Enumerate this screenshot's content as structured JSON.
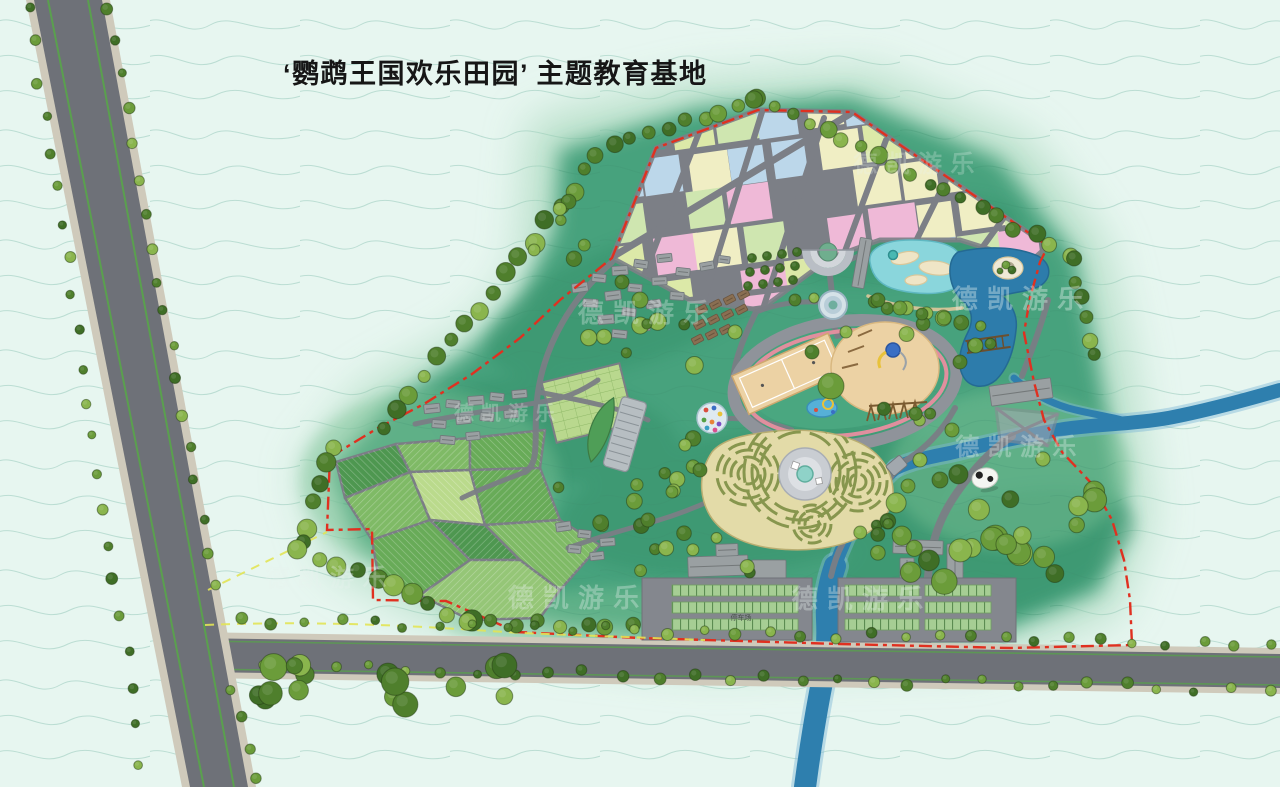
{
  "title": {
    "text": "‘鹦鹉王国欢乐田园’ 主题教育基地"
  },
  "labels": {
    "parking": "停车场"
  },
  "watermark": {
    "text": "德凯游乐",
    "color": "#e8f1ee",
    "instances": [
      [
        648,
        322,
        26,
        0.32
      ],
      [
        508,
        420,
        20,
        0.28
      ],
      [
        918,
        172,
        24,
        0.26
      ],
      [
        1022,
        308,
        26,
        0.38
      ],
      [
        1020,
        455,
        24,
        0.34
      ],
      [
        330,
        586,
        24,
        0.3
      ],
      [
        578,
        607,
        26,
        0.34
      ],
      [
        862,
        608,
        26,
        0.34
      ]
    ]
  },
  "colors": {
    "background_mint": "#e7f6f0",
    "contour": "#a9d4c6",
    "park_green": "#46a27d",
    "road_gray": "#6e7178",
    "path_gray": "#7b7e85",
    "verge_tan": "#cfcabb",
    "river_blue": "#2e7fae",
    "lagoon_cyan": "#8ad6dc",
    "boundary_red": "#e03020",
    "boundary_yellow": "#e6e85a",
    "track_pink": "#e08f9e",
    "sand_tan": "#ecd2a4",
    "maze_straw": "#e3dba8"
  },
  "map": {
    "tree_palette": [
      "#4f7f2c",
      "#6b9c3a",
      "#8ab54d",
      "#3f6e26"
    ],
    "tree_lines": [
      [
        598,
        152,
        756,
        98,
        17,
        5,
        9
      ],
      [
        756,
        98,
        1068,
        252,
        19,
        5,
        9
      ],
      [
        585,
        172,
        385,
        426,
        21,
        6,
        10
      ],
      [
        332,
        446,
        300,
        545,
        19,
        7,
        10
      ],
      [
        300,
        550,
        468,
        620,
        19,
        7,
        11
      ],
      [
        468,
        622,
        632,
        626,
        21,
        6,
        9
      ],
      [
        240,
        620,
        1268,
        646,
        33,
        4,
        6
      ],
      [
        262,
        666,
        1268,
        690,
        35,
        4,
        6
      ],
      [
        30,
        8,
        142,
        762,
        36,
        4,
        6
      ],
      [
        108,
        8,
        214,
        585,
        33,
        4,
        6
      ],
      [
        872,
        300,
        962,
        322,
        17,
        6,
        8
      ],
      [
        1072,
        262,
        1098,
        356,
        18,
        6,
        9
      ],
      [
        228,
        688,
        258,
        780,
        28,
        4,
        6
      ]
    ],
    "tree_clusters": [
      [
        385,
        688,
        140,
        26,
        16,
        8,
        14
      ],
      [
        1000,
        525,
        108,
        68,
        24,
        7,
        13
      ],
      [
        640,
        352,
        58,
        42,
        8,
        5,
        9
      ],
      [
        700,
        552,
        66,
        22,
        8,
        5,
        8
      ],
      [
        600,
        498,
        46,
        34,
        6,
        5,
        8
      ],
      [
        950,
        332,
        44,
        20,
        5,
        5,
        8
      ],
      [
        682,
        468,
        22,
        32,
        5,
        5,
        8
      ],
      [
        560,
        238,
        26,
        40,
        6,
        5,
        9
      ],
      [
        868,
        540,
        40,
        22,
        6,
        5,
        8
      ],
      [
        905,
        420,
        26,
        16,
        4,
        5,
        7
      ]
    ],
    "tree_singles": [
      [
        831,
        386,
        13,
        1
      ],
      [
        812,
        352,
        7,
        0
      ],
      [
        846,
        332,
        6,
        2
      ],
      [
        795,
        300,
        6,
        0
      ],
      [
        814,
        298,
        5,
        2
      ],
      [
        878,
        300,
        7,
        0
      ],
      [
        900,
        308,
        7,
        1
      ],
      [
        922,
        314,
        6,
        0
      ],
      [
        944,
        318,
        7,
        1
      ],
      [
        735,
        332,
        7,
        2
      ],
      [
        960,
        362,
        7,
        0
      ],
      [
        952,
        430,
        7,
        1
      ],
      [
        700,
        470,
        7,
        0
      ],
      [
        685,
        445,
        6,
        2
      ],
      [
        672,
        492,
        6,
        1
      ],
      [
        648,
        520,
        7,
        0
      ],
      [
        920,
        460,
        7,
        2
      ],
      [
        940,
        480,
        8,
        0
      ],
      [
        908,
        486,
        7,
        1
      ],
      [
        1006,
        265,
        4,
        1
      ],
      [
        1012,
        270,
        4,
        3
      ],
      [
        1000,
        271,
        3,
        0
      ],
      [
        640,
        300,
        8,
        1
      ],
      [
        622,
        282,
        7,
        0
      ]
    ],
    "orchard": {
      "x0": 752,
      "y0": 258,
      "cols": 4,
      "rows": 3,
      "dx": 15,
      "dy": 14,
      "r": 4.5
    },
    "plot_grid": {
      "x0": 596,
      "y0": 92,
      "cols": 12,
      "rows": 6,
      "cw": 40,
      "ch": 37,
      "gapx": 4,
      "gapy": 4,
      "rot": -8,
      "cx": 830,
      "cy": 200,
      "seed": 7,
      "palette": [
        "#efb9d7",
        "#f0eec4",
        "#dce9a8",
        "#bcd7ea",
        "#cfe6b0",
        "#3fa393"
      ],
      "weights": [
        0.3,
        0.22,
        0.18,
        0.14,
        0.12,
        0.04
      ]
    },
    "plot_roads": [
      [
        614,
        256,
        850,
        114,
        7
      ],
      [
        690,
        300,
        1040,
        258,
        6
      ],
      [
        700,
        130,
        636,
        296,
        6
      ],
      [
        762,
        112,
        700,
        312,
        6
      ],
      [
        824,
        118,
        762,
        312,
        6
      ],
      [
        886,
        140,
        824,
        308,
        6
      ],
      [
        948,
        176,
        886,
        302,
        6
      ],
      [
        1008,
        212,
        950,
        292,
        6
      ]
    ],
    "fields": {
      "tones": [
        "#4e9750",
        "#68ab58",
        "#7fba66",
        "#95c677",
        "#bada8c"
      ],
      "polys": [
        {
          "pts": "336,462 396,444 410,472 345,498",
          "t": 0
        },
        {
          "pts": "396,444 470,438 470,470 410,472",
          "t": 2
        },
        {
          "pts": "470,438 545,430 540,468 470,470",
          "t": 1
        },
        {
          "pts": "345,498 410,472 430,520 372,540",
          "t": 2
        },
        {
          "pts": "410,472 470,470 485,525 430,520",
          "t": 4
        },
        {
          "pts": "470,470 540,468 560,520 485,525",
          "t": 1
        },
        {
          "pts": "372,540 430,520 470,560 420,595 380,585",
          "t": 1
        },
        {
          "pts": "430,520 485,525 520,560 470,560",
          "t": 0
        },
        {
          "pts": "485,525 560,520 600,545 560,590 520,560",
          "t": 2
        },
        {
          "pts": "420,595 470,560 520,560 560,590 540,618 470,620",
          "t": 3
        }
      ]
    },
    "buildings": [
      [
        572,
        283,
        16,
        9,
        -8,
        "g"
      ],
      [
        592,
        274,
        14,
        8,
        6,
        "g"
      ],
      [
        612,
        266,
        16,
        9,
        -4,
        "g"
      ],
      [
        634,
        260,
        14,
        8,
        8,
        "g"
      ],
      [
        657,
        254,
        15,
        8,
        -6,
        "g"
      ],
      [
        583,
        299,
        15,
        8,
        4,
        "g"
      ],
      [
        605,
        291,
        16,
        9,
        -7,
        "g"
      ],
      [
        628,
        284,
        14,
        8,
        5,
        "g"
      ],
      [
        652,
        277,
        15,
        8,
        -3,
        "g"
      ],
      [
        676,
        268,
        14,
        8,
        6,
        "g"
      ],
      [
        598,
        315,
        16,
        9,
        -5,
        "g"
      ],
      [
        622,
        308,
        14,
        8,
        7,
        "g"
      ],
      [
        646,
        300,
        15,
        8,
        -8,
        "g"
      ],
      [
        670,
        292,
        14,
        8,
        4,
        "g"
      ],
      [
        612,
        330,
        15,
        8,
        6,
        "g"
      ],
      [
        636,
        323,
        14,
        8,
        -5,
        "g"
      ],
      [
        700,
        262,
        14,
        8,
        -10,
        "g"
      ],
      [
        718,
        256,
        12,
        7,
        8,
        "g"
      ],
      [
        424,
        404,
        16,
        9,
        -6,
        "g"
      ],
      [
        446,
        400,
        14,
        8,
        5,
        "g"
      ],
      [
        468,
        396,
        16,
        9,
        -4,
        "g"
      ],
      [
        490,
        393,
        14,
        8,
        6,
        "g"
      ],
      [
        512,
        390,
        15,
        8,
        -5,
        "g"
      ],
      [
        432,
        420,
        14,
        8,
        4,
        "g"
      ],
      [
        456,
        416,
        15,
        8,
        -6,
        "g"
      ],
      [
        480,
        413,
        14,
        8,
        5,
        "g"
      ],
      [
        504,
        410,
        14,
        8,
        -4,
        "g"
      ],
      [
        440,
        436,
        15,
        8,
        5,
        "g"
      ],
      [
        466,
        432,
        14,
        8,
        -5,
        "g"
      ],
      [
        556,
        522,
        15,
        9,
        -8,
        "g"
      ],
      [
        578,
        530,
        13,
        8,
        6,
        "g"
      ],
      [
        600,
        538,
        15,
        8,
        -4,
        "g"
      ],
      [
        568,
        545,
        13,
        8,
        5,
        "g"
      ],
      [
        590,
        552,
        14,
        8,
        -6,
        "g"
      ],
      [
        688,
        556,
        60,
        20,
        -2,
        "g"
      ],
      [
        752,
        560,
        34,
        26,
        0,
        "g"
      ],
      [
        716,
        544,
        22,
        12,
        -2,
        "g"
      ],
      [
        893,
        540,
        50,
        14,
        2,
        "g"
      ],
      [
        947,
        544,
        16,
        34,
        0,
        "g"
      ],
      [
        900,
        558,
        14,
        22,
        0,
        "g"
      ],
      [
        920,
        586,
        12,
        12,
        0,
        "w"
      ],
      [
        990,
        382,
        62,
        20,
        -8,
        "g"
      ],
      [
        856,
        238,
        12,
        50,
        10,
        "g"
      ],
      [
        696,
        306,
        11,
        7,
        -28,
        "b"
      ],
      [
        710,
        301,
        11,
        7,
        -28,
        "b"
      ],
      [
        724,
        296,
        11,
        7,
        -28,
        "b"
      ],
      [
        738,
        291,
        11,
        7,
        -28,
        "b"
      ],
      [
        694,
        321,
        11,
        7,
        -28,
        "b"
      ],
      [
        708,
        316,
        11,
        7,
        -28,
        "b"
      ],
      [
        722,
        311,
        11,
        7,
        -28,
        "b"
      ],
      [
        736,
        306,
        11,
        7,
        -28,
        "b"
      ],
      [
        692,
        336,
        11,
        7,
        -28,
        "b"
      ],
      [
        706,
        331,
        11,
        7,
        -28,
        "b"
      ],
      [
        720,
        326,
        11,
        7,
        -28,
        "b"
      ]
    ],
    "parking": {
      "lots": [
        [
          642,
          578,
          170,
          62
        ],
        [
          838,
          578,
          178,
          64
        ]
      ],
      "rows": [
        [
          672,
          585,
          126,
          11
        ],
        [
          672,
          602,
          126,
          11
        ],
        [
          672,
          619,
          126,
          11
        ],
        [
          845,
          585,
          74,
          11
        ],
        [
          845,
          602,
          74,
          11
        ],
        [
          845,
          619,
          74,
          11
        ],
        [
          925,
          585,
          66,
          11
        ],
        [
          925,
          602,
          66,
          11
        ],
        [
          925,
          619,
          66,
          11
        ]
      ]
    }
  }
}
